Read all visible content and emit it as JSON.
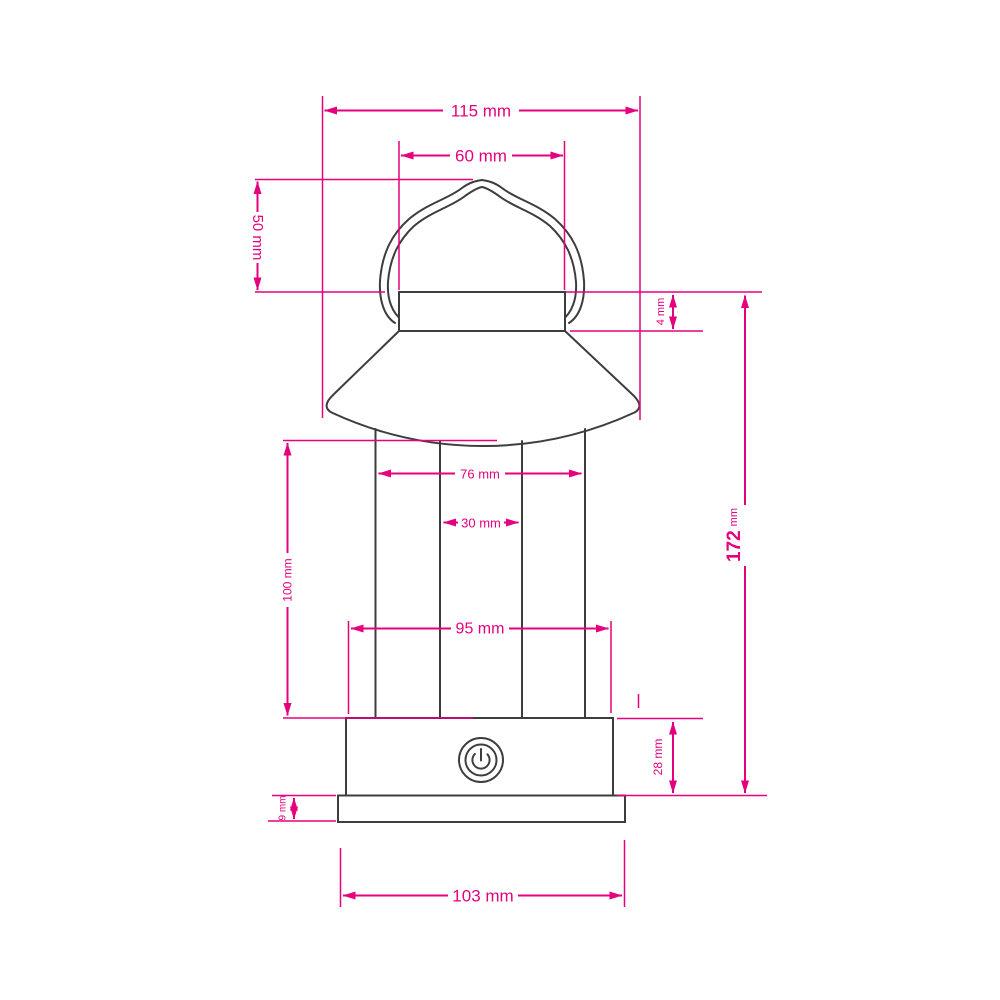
{
  "drawing": {
    "type": "product-dimension-diagram",
    "subject": "camping lantern side view with dimensions"
  },
  "colors": {
    "accent": "#e5007e",
    "outline": "#3d3d3d",
    "background": "#ffffff"
  },
  "icons": {
    "power_button": "power-icon"
  },
  "dimensions": {
    "shade_width": "115 mm",
    "cap_width": "60 mm",
    "handle_height": "50 mm",
    "cap_band_height": "4 mm",
    "total_height": {
      "value": "172",
      "unit": "mm"
    },
    "column_outer_width": "76 mm",
    "column_inner_width": "30 mm",
    "column_height": "100 mm",
    "base_width": "95 mm",
    "base_height": "28 mm",
    "foot_height": "9 mm",
    "foot_width": "103 mm"
  }
}
